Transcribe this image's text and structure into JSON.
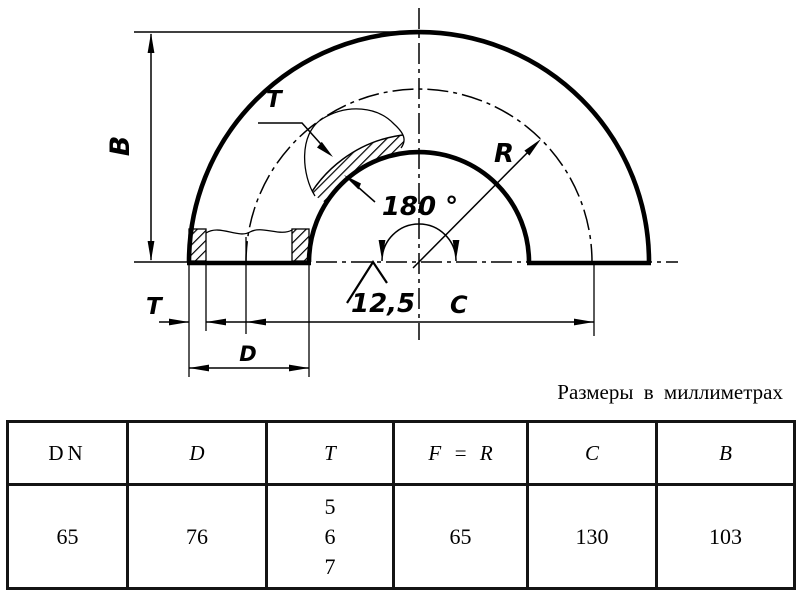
{
  "caption": "Размеры в миллиметрах",
  "drawing": {
    "labels": {
      "b": "B",
      "t_section": "T",
      "r": "R",
      "angle": "180 °",
      "roughness": "12,5",
      "t_dim": "T",
      "d": "D",
      "c": "C"
    },
    "line_color": "#000000",
    "background": "#ffffff"
  },
  "table": {
    "headers": [
      "DN",
      "D",
      "T",
      "F = R",
      "C",
      "B"
    ],
    "row": {
      "dn": "65",
      "d": "76",
      "t": [
        "5",
        "6",
        "7"
      ],
      "f_r": "65",
      "c": "130",
      "b": "103"
    }
  }
}
